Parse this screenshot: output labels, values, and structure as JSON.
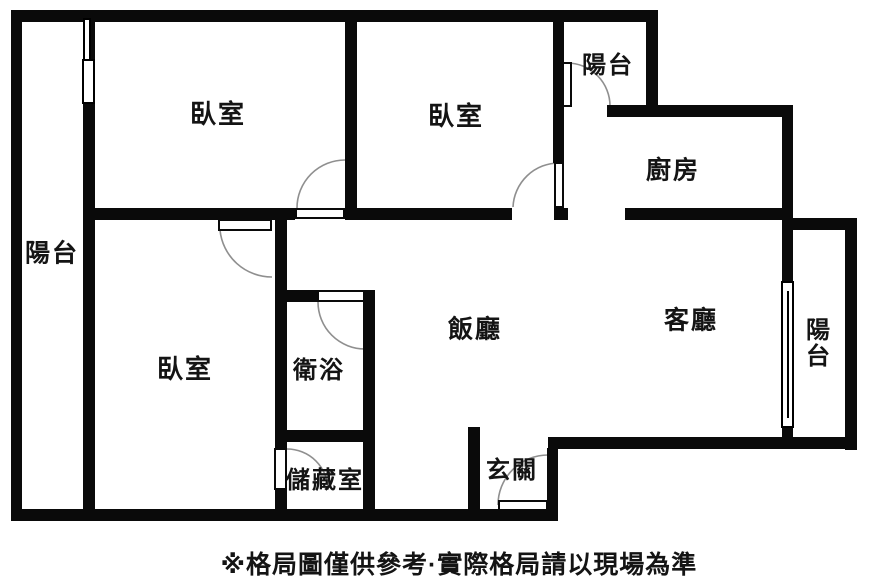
{
  "caption": "※格局圖僅供參考·實際格局請以現場為準",
  "caption_pos": {
    "x": 459,
    "y": 563
  },
  "colors": {
    "wall": "#0a0a0a",
    "arc": "#8f8f8f",
    "background": "#ffffff",
    "text": "#141414"
  },
  "canvas": {
    "width": 889,
    "height": 585
  },
  "rooms": [
    {
      "id": "bedroom-top-left",
      "label": "臥室",
      "x": 218,
      "y": 114,
      "size": 26
    },
    {
      "id": "bedroom-top-middle",
      "label": "臥室",
      "x": 456,
      "y": 116,
      "size": 26
    },
    {
      "id": "bedroom-bottom-left",
      "label": "臥室",
      "x": 185,
      "y": 369,
      "size": 26
    },
    {
      "id": "balcony-left",
      "label": "陽台",
      "x": 52,
      "y": 254,
      "size": 25
    },
    {
      "id": "balcony-top",
      "label": "陽台",
      "x": 608,
      "y": 66,
      "size": 24
    },
    {
      "id": "balcony-right",
      "label": "陽台",
      "x": 819,
      "y": 344,
      "size": 24,
      "vertical": true
    },
    {
      "id": "kitchen",
      "label": "廚房",
      "x": 673,
      "y": 171,
      "size": 25
    },
    {
      "id": "living-room",
      "label": "客廳",
      "x": 691,
      "y": 321,
      "size": 25
    },
    {
      "id": "dining-room",
      "label": "飯廳",
      "x": 475,
      "y": 330,
      "size": 25
    },
    {
      "id": "bathroom",
      "label": "衛浴",
      "x": 319,
      "y": 371,
      "size": 24
    },
    {
      "id": "storage-room",
      "label": "儲藏室",
      "x": 325,
      "y": 481,
      "size": 24
    },
    {
      "id": "entryway",
      "label": "玄關",
      "x": 512,
      "y": 471,
      "size": 24
    }
  ],
  "walls": [
    {
      "name": "outer-top-wall",
      "x": 11,
      "y": 10,
      "w": 647,
      "h": 12
    },
    {
      "name": "outer-left-wall",
      "x": 11,
      "y": 10,
      "w": 11,
      "h": 511
    },
    {
      "name": "outer-bottom-left-wall",
      "x": 11,
      "y": 509,
      "w": 547,
      "h": 12
    },
    {
      "name": "entry-right-wall",
      "x": 547,
      "y": 448,
      "w": 11,
      "h": 73
    },
    {
      "name": "living-bottom-wall",
      "x": 548,
      "y": 437,
      "w": 309,
      "h": 12
    },
    {
      "name": "outer-right-wall",
      "x": 845,
      "y": 218,
      "w": 12,
      "h": 232
    },
    {
      "name": "right-balcony-top-wall",
      "x": 793,
      "y": 218,
      "w": 64,
      "h": 12
    },
    {
      "name": "kitchen-right-wall",
      "x": 782,
      "y": 105,
      "w": 11,
      "h": 115
    },
    {
      "name": "kitchen-top-wall",
      "x": 607,
      "y": 105,
      "w": 186,
      "h": 12
    },
    {
      "name": "top-balcony-right-wall",
      "x": 646,
      "y": 10,
      "w": 12,
      "h": 107
    },
    {
      "name": "living-balcony-divider",
      "x": 782,
      "y": 220,
      "w": 11,
      "h": 217
    },
    {
      "name": "left-balcony-divider",
      "x": 83,
      "y": 20,
      "w": 12,
      "h": 490
    },
    {
      "name": "hall-wall-west",
      "x": 83,
      "y": 208,
      "w": 212,
      "h": 12
    },
    {
      "name": "hall-wall-mid",
      "x": 345,
      "y": 208,
      "w": 167,
      "h": 12
    },
    {
      "name": "hall-wall-east",
      "x": 554,
      "y": 208,
      "w": 14,
      "h": 12
    },
    {
      "name": "kitchen-bottom-wall",
      "x": 625,
      "y": 208,
      "w": 168,
      "h": 12
    },
    {
      "name": "bedroom-divider-wall",
      "x": 345,
      "y": 20,
      "w": 12,
      "h": 200
    },
    {
      "name": "bedroom2-right-wall",
      "x": 553,
      "y": 20,
      "w": 11,
      "h": 143
    },
    {
      "name": "bath-column-left-wall",
      "x": 275,
      "y": 220,
      "w": 12,
      "h": 228
    },
    {
      "name": "bath-column-left-low-wall",
      "x": 275,
      "y": 490,
      "w": 12,
      "h": 20
    },
    {
      "name": "bathroom-top-wall",
      "x": 287,
      "y": 290,
      "w": 30,
      "h": 12
    },
    {
      "name": "bath-column-right-wall",
      "x": 363,
      "y": 290,
      "w": 12,
      "h": 220
    },
    {
      "name": "bathroom-bottom-wall",
      "x": 275,
      "y": 430,
      "w": 100,
      "h": 12
    },
    {
      "name": "entry-left-wall",
      "x": 468,
      "y": 427,
      "w": 12,
      "h": 94
    }
  ],
  "windows": [
    {
      "name": "bedroom1-balcony-window-upper",
      "x": 83,
      "y": 18,
      "w": 8,
      "h": 43
    },
    {
      "name": "bedroom1-balcony-window-lower",
      "x": 82,
      "y": 59,
      "w": 13,
      "h": 45
    },
    {
      "name": "living-balcony-window",
      "x": 781,
      "y": 281,
      "w": 13,
      "h": 147,
      "centerLine": true
    }
  ],
  "doors": [
    {
      "name": "bedroom1-door",
      "leaf": {
        "x": 295,
        "y": 208,
        "w": 50,
        "h": 11
      },
      "arc": "M297,208 A48,48 0 0 1 345,160"
    },
    {
      "name": "bedroom3-door",
      "leaf": {
        "x": 218,
        "y": 219,
        "w": 54,
        "h": 12
      },
      "arc": "M220,230 A52,52 0 0 0 272,277"
    },
    {
      "name": "bedroom2-door",
      "leaf": {
        "x": 554,
        "y": 162,
        "w": 10,
        "h": 46
      },
      "arc": "M559,163 A46,46 0 0 0 513,207"
    },
    {
      "name": "top-balcony-door",
      "leaf": {
        "x": 562,
        "y": 62,
        "w": 10,
        "h": 45
      },
      "arc": "M567,63 A43,43 0 0 1 610,106"
    },
    {
      "name": "bathroom-door",
      "leaf": {
        "x": 317,
        "y": 290,
        "w": 48,
        "h": 12
      },
      "arc": "M318,302 A47,47 0 0 0 365,349"
    },
    {
      "name": "storage-door",
      "leaf": {
        "x": 274,
        "y": 448,
        "w": 13,
        "h": 42
      },
      "arc": "M287,449 A41,41 0 0 1 328,490"
    },
    {
      "name": "entry-door",
      "leaf": {
        "x": 498,
        "y": 500,
        "w": 50,
        "h": 11
      },
      "arc": "M498,505 A50,50 0 0 1 548,455"
    }
  ]
}
